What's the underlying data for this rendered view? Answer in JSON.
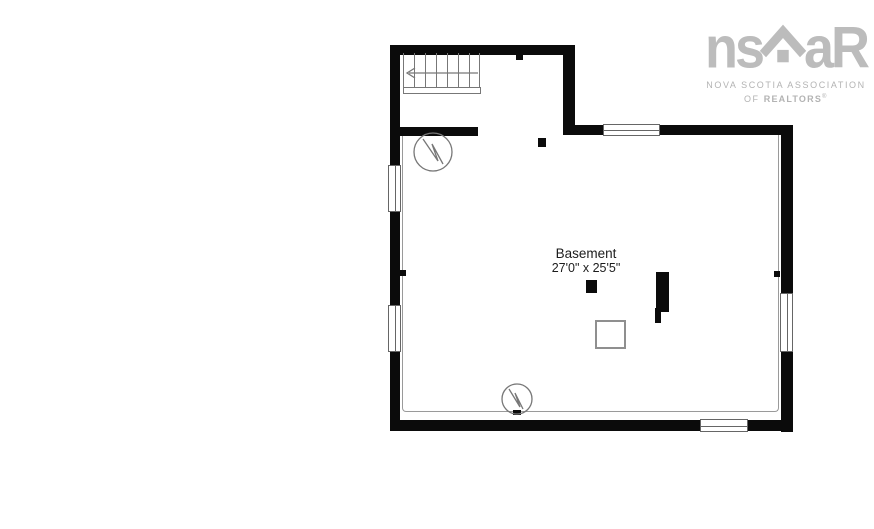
{
  "colors": {
    "wall": "#0b0b0b",
    "thin_line": "#8a8a8a",
    "text": "#1c1c1c",
    "logo": "#bcbcbc",
    "background": "#ffffff"
  },
  "floorplan": {
    "room_label": "Basement",
    "room_dimensions": "27'0\" x 25'5\"",
    "icons": {
      "stairs": "staircase-with-direction-arrow",
      "water_heater_upper": "circle-zigzag-utility-symbol",
      "water_heater_lower": "circle-zigzag-utility-symbol",
      "windows": "double-line-window-symbol",
      "posts": "solid-black-post-symbol"
    }
  },
  "logo": {
    "wordmark_left": "ns",
    "wordmark_right": "aR",
    "house_icon": "house-roof-icon",
    "line1": "NOVA SCOTIA ASSOCIATION",
    "line2_of": "OF ",
    "line2_realtors": "REALTORS",
    "line2_mark": "®"
  }
}
